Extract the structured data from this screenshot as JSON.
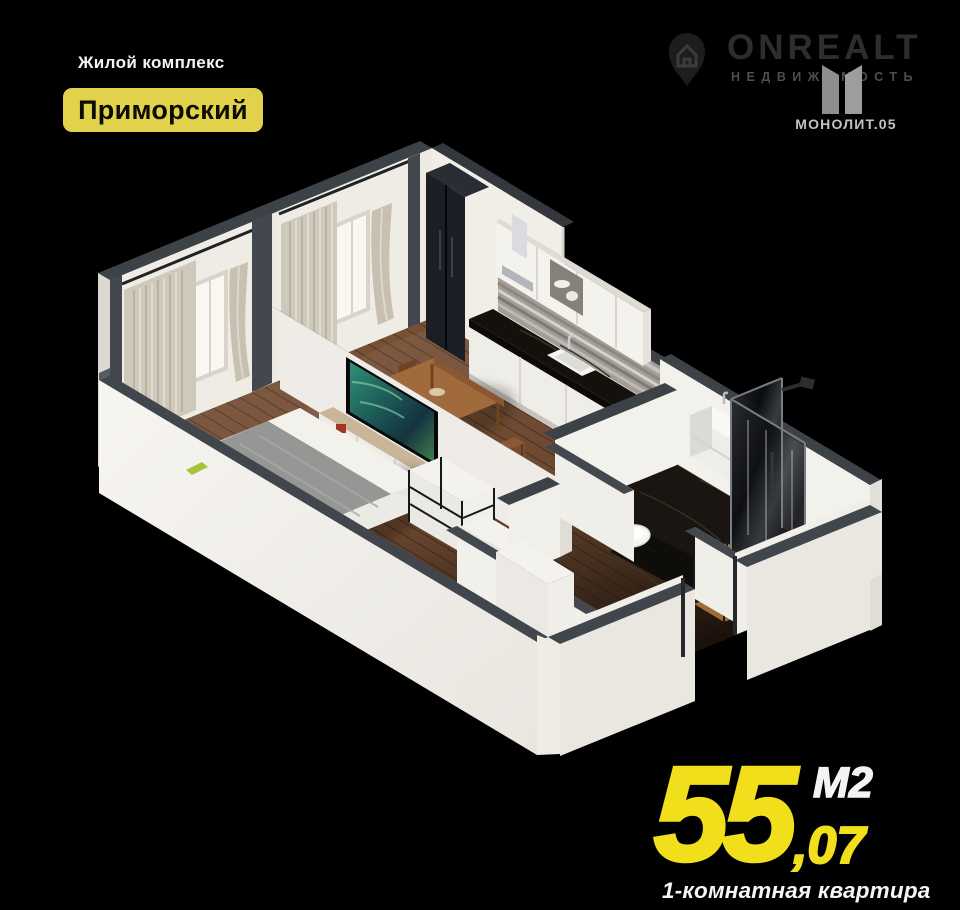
{
  "page": {
    "width": 960,
    "height": 910,
    "background": "#000000"
  },
  "header": {
    "complex_label": "Жилой комплекс",
    "complex_name": "Приморский"
  },
  "branding": {
    "onrealt": {
      "name": "ONREALT",
      "tagline": "НЕДВИЖИМОСТЬ"
    },
    "monolit": {
      "name": "МОНОЛИТ.05"
    }
  },
  "area": {
    "value": "55",
    "fraction": ",07",
    "unit": "М2"
  },
  "footer": {
    "apartment_type": "1-комнатная квартира"
  },
  "palette": {
    "accent_yellow": "#f2df1c",
    "badge_yellow": "#e2d14b",
    "wall_face": "#f2efe9",
    "wall_top": "#3d4247",
    "floor_wood": "#6d4a30",
    "bathroom_marble": "#1a1511",
    "curtain_beige": "#cfc9bb",
    "monolit_gray": "#9a9a9a",
    "onrealt_gray": "#2e2e2e"
  }
}
